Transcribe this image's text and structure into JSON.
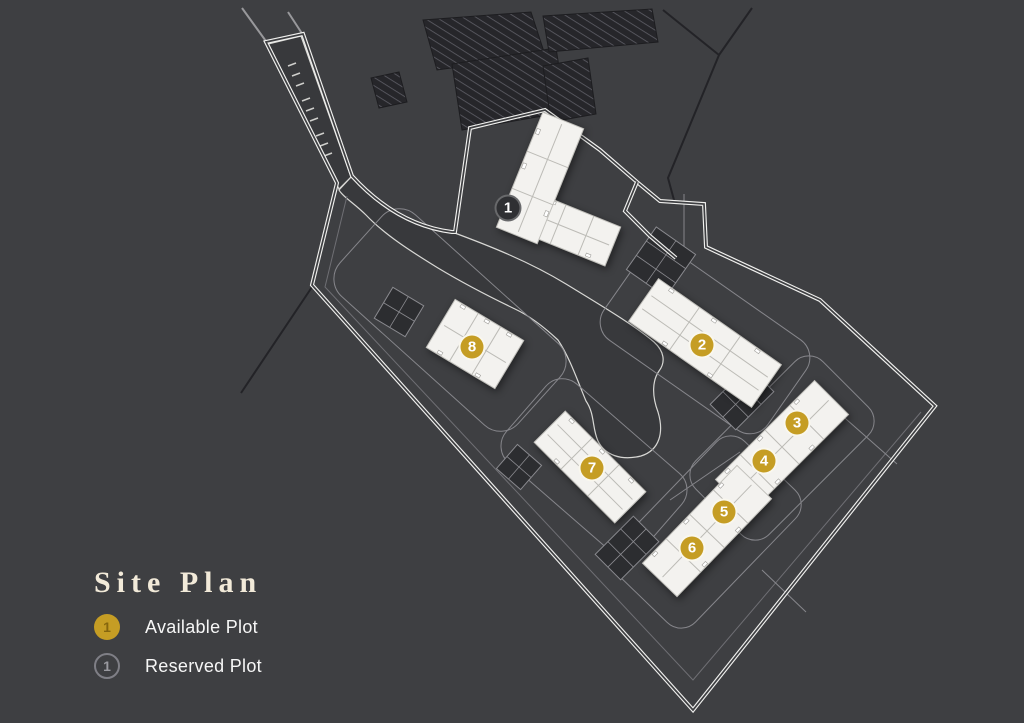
{
  "title": "Site Plan",
  "legend": {
    "available": {
      "number": "1",
      "label": "Available Plot"
    },
    "reserved": {
      "number": "1",
      "label": "Reserved Plot"
    }
  },
  "colors": {
    "background": "#3e3f42",
    "road": "#38393c",
    "available_gold": "#c59d24",
    "reserved_fill": "#2f3033",
    "building": "#f3f2ef",
    "boundary_line": "#f0f0ee",
    "title_text": "#f2ead9",
    "label_text": "#f6f6f6"
  },
  "plots": [
    {
      "number": "1",
      "status": "reserved",
      "x": 508,
      "y": 208
    },
    {
      "number": "2",
      "status": "available",
      "x": 702,
      "y": 345
    },
    {
      "number": "3",
      "status": "available",
      "x": 797,
      "y": 423
    },
    {
      "number": "4",
      "status": "available",
      "x": 764,
      "y": 461
    },
    {
      "number": "5",
      "status": "available",
      "x": 724,
      "y": 512
    },
    {
      "number": "6",
      "status": "available",
      "x": 692,
      "y": 548
    },
    {
      "number": "7",
      "status": "available",
      "x": 592,
      "y": 468
    },
    {
      "number": "8",
      "status": "available",
      "x": 472,
      "y": 347
    }
  ]
}
